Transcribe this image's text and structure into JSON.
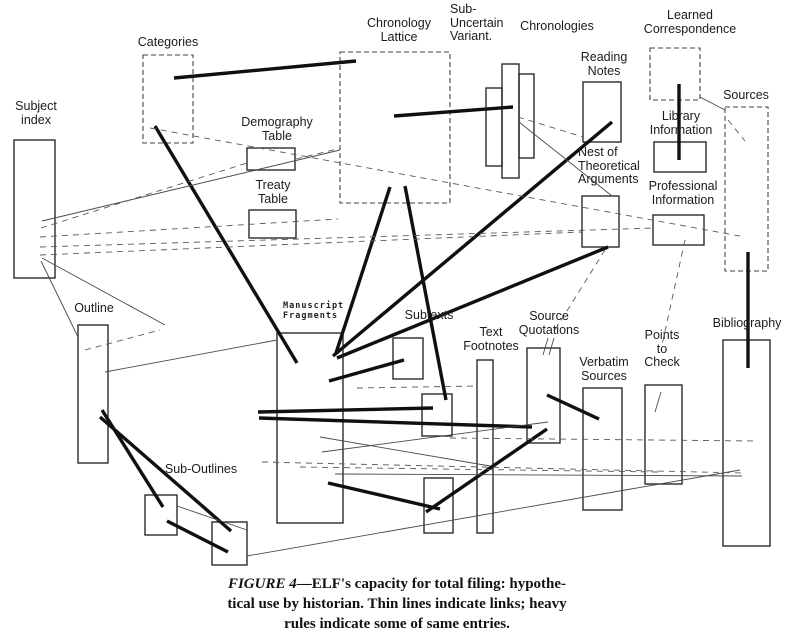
{
  "colors": {
    "ink": "#1b1b1b",
    "paper": "#ffffff"
  },
  "nodes": [
    {
      "id": "subject-index",
      "lines": [
        "Subject",
        "index"
      ],
      "label": {
        "x": 36,
        "y": 100,
        "align": "center"
      },
      "border": "solid",
      "boxes": [
        {
          "x": 14,
          "y": 140,
          "w": 41,
          "h": 138
        }
      ]
    },
    {
      "id": "categories",
      "lines": [
        "Categories"
      ],
      "label": {
        "x": 168,
        "y": 36,
        "align": "center"
      },
      "border": "dashed",
      "boxes": [
        {
          "x": 143,
          "y": 55,
          "w": 50,
          "h": 88
        }
      ]
    },
    {
      "id": "demography-table",
      "lines": [
        "Demography",
        "Table"
      ],
      "label": {
        "x": 277,
        "y": 116,
        "align": "center"
      },
      "border": "solid",
      "boxes": [
        {
          "x": 247,
          "y": 148,
          "w": 48,
          "h": 22
        }
      ]
    },
    {
      "id": "treaty-table",
      "lines": [
        "Treaty",
        "Table"
      ],
      "label": {
        "x": 273,
        "y": 179,
        "align": "center"
      },
      "border": "solid",
      "boxes": [
        {
          "x": 249,
          "y": 210,
          "w": 47,
          "h": 28
        }
      ]
    },
    {
      "id": "chronology-lattice",
      "lines": [
        "Chronology",
        "Lattice"
      ],
      "label": {
        "x": 399,
        "y": 17,
        "align": "center"
      },
      "border": "dashed",
      "boxes": [
        {
          "x": 340,
          "y": 52,
          "w": 110,
          "h": 151
        }
      ]
    },
    {
      "id": "sub-uncertain-variant",
      "lines": [
        "Sub-",
        "Uncertain",
        "Variant."
      ],
      "label": {
        "x": 450,
        "y": 3,
        "align": "left"
      },
      "border": "solid",
      "boxes": []
    },
    {
      "id": "chronologies",
      "lines": [
        "Chronologies"
      ],
      "label": {
        "x": 557,
        "y": 20,
        "align": "center"
      },
      "border": "solid",
      "boxes": [
        {
          "x": 486,
          "y": 88,
          "w": 16,
          "h": 78
        },
        {
          "x": 502,
          "y": 64,
          "w": 17,
          "h": 114
        },
        {
          "x": 519,
          "y": 74,
          "w": 15,
          "h": 84
        }
      ]
    },
    {
      "id": "reading-notes",
      "lines": [
        "Reading",
        "Notes"
      ],
      "label": {
        "x": 604,
        "y": 51,
        "align": "center"
      },
      "border": "solid",
      "boxes": [
        {
          "x": 583,
          "y": 82,
          "w": 38,
          "h": 60
        }
      ]
    },
    {
      "id": "learned-correspondence",
      "lines": [
        "Learned",
        "Correspondence"
      ],
      "label": {
        "x": 690,
        "y": 9,
        "align": "center"
      },
      "border": "dashed",
      "boxes": [
        {
          "x": 650,
          "y": 48,
          "w": 50,
          "h": 52
        }
      ]
    },
    {
      "id": "sources",
      "lines": [
        "Sources"
      ],
      "label": {
        "x": 746,
        "y": 89,
        "align": "center"
      },
      "border": "dashed",
      "boxes": [
        {
          "x": 725,
          "y": 107,
          "w": 43,
          "h": 164
        }
      ]
    },
    {
      "id": "library-information",
      "lines": [
        "Library",
        "Information"
      ],
      "label": {
        "x": 681,
        "y": 110,
        "align": "center"
      },
      "border": "solid",
      "boxes": [
        {
          "x": 654,
          "y": 142,
          "w": 52,
          "h": 30
        }
      ]
    },
    {
      "id": "nest-of-theoretical-arguments",
      "lines": [
        "Nest of",
        "Theoretical",
        "Arguments"
      ],
      "label": {
        "x": 578,
        "y": 146,
        "align": "left"
      },
      "border": "solid",
      "boxes": [
        {
          "x": 582,
          "y": 196,
          "w": 37,
          "h": 51
        }
      ]
    },
    {
      "id": "professional-information",
      "lines": [
        "Professional",
        "Information"
      ],
      "label": {
        "x": 683,
        "y": 180,
        "align": "center"
      },
      "border": "solid",
      "boxes": [
        {
          "x": 653,
          "y": 215,
          "w": 51,
          "h": 30
        }
      ]
    },
    {
      "id": "outline",
      "lines": [
        "Outline"
      ],
      "label": {
        "x": 94,
        "y": 302,
        "align": "center"
      },
      "border": "solid",
      "boxes": [
        {
          "x": 78,
          "y": 325,
          "w": 30,
          "h": 138
        }
      ]
    },
    {
      "id": "manuscript-fragments",
      "lines": [
        "Manuscript",
        "Fragments"
      ],
      "label": {
        "x": 283,
        "y": 301,
        "align": "left"
      },
      "font": "mono",
      "border": "solid",
      "boxes": [
        {
          "x": 277,
          "y": 333,
          "w": 66,
          "h": 190
        }
      ]
    },
    {
      "id": "subtexts",
      "lines": [
        "Subtexts"
      ],
      "label": {
        "x": 429,
        "y": 309,
        "align": "center"
      },
      "border": "solid",
      "boxes": [
        {
          "x": 393,
          "y": 338,
          "w": 30,
          "h": 41
        },
        {
          "x": 422,
          "y": 394,
          "w": 30,
          "h": 42
        },
        {
          "x": 424,
          "y": 478,
          "w": 29,
          "h": 55
        }
      ]
    },
    {
      "id": "text-footnotes",
      "lines": [
        "Text",
        "Footnotes"
      ],
      "label": {
        "x": 491,
        "y": 326,
        "align": "center"
      },
      "border": "solid",
      "boxes": [
        {
          "x": 477,
          "y": 360,
          "w": 16,
          "h": 173
        }
      ]
    },
    {
      "id": "source-quotations",
      "lines": [
        "Source",
        "Quotations"
      ],
      "label": {
        "x": 549,
        "y": 310,
        "align": "center"
      },
      "border": "solid",
      "boxes": [
        {
          "x": 527,
          "y": 348,
          "w": 33,
          "h": 95
        }
      ]
    },
    {
      "id": "verbatim-sources",
      "lines": [
        "Verbatim",
        "Sources"
      ],
      "label": {
        "x": 604,
        "y": 356,
        "align": "center"
      },
      "border": "solid",
      "boxes": [
        {
          "x": 583,
          "y": 388,
          "w": 39,
          "h": 122
        }
      ]
    },
    {
      "id": "points-to-check",
      "lines": [
        "Points",
        "to",
        "Check"
      ],
      "label": {
        "x": 662,
        "y": 329,
        "align": "center"
      },
      "border": "solid",
      "boxes": [
        {
          "x": 645,
          "y": 385,
          "w": 37,
          "h": 99
        }
      ]
    },
    {
      "id": "bibliography",
      "lines": [
        "Bibliography"
      ],
      "label": {
        "x": 747,
        "y": 317,
        "align": "center"
      },
      "border": "solid",
      "boxes": [
        {
          "x": 723,
          "y": 340,
          "w": 47,
          "h": 206
        }
      ]
    },
    {
      "id": "sub-outlines",
      "lines": [
        "Sub-Outlines"
      ],
      "label": {
        "x": 201,
        "y": 463,
        "align": "center"
      },
      "border": "solid",
      "boxes": [
        {
          "x": 145,
          "y": 495,
          "w": 32,
          "h": 40
        },
        {
          "x": 212,
          "y": 522,
          "w": 35,
          "h": 43
        }
      ]
    }
  ],
  "links": {
    "heavy": [
      [
        174,
        78,
        356,
        61
      ],
      [
        155,
        126,
        297,
        363
      ],
      [
        394,
        116,
        513,
        107
      ],
      [
        390,
        187,
        336,
        353
      ],
      [
        405,
        186,
        446,
        400
      ],
      [
        333,
        356,
        612,
        122
      ],
      [
        337,
        358,
        608,
        247
      ],
      [
        329,
        381,
        404,
        360
      ],
      [
        258,
        412,
        433,
        408
      ],
      [
        259,
        418,
        532,
        427
      ],
      [
        328,
        483,
        440,
        509
      ],
      [
        426,
        512,
        547,
        429
      ],
      [
        102,
        410,
        163,
        507
      ],
      [
        100,
        417,
        231,
        531
      ],
      [
        167,
        521,
        228,
        552
      ],
      [
        547,
        395,
        599,
        419
      ],
      [
        679,
        84,
        679,
        160
      ],
      [
        748,
        252,
        748,
        368
      ]
    ],
    "thin": [
      [
        42,
        221,
        340,
        150
      ],
      [
        41,
        261,
        78,
        337
      ],
      [
        42,
        258,
        165,
        325
      ],
      [
        700,
        97,
        725,
        110
      ],
      [
        322,
        452,
        548,
        422
      ],
      [
        320,
        437,
        490,
        466
      ],
      [
        247,
        556,
        740,
        470
      ],
      [
        177,
        506,
        247,
        530
      ],
      [
        105,
        372,
        277,
        340
      ],
      [
        335,
        474,
        742,
        476
      ],
      [
        661,
        392,
        655,
        412
      ],
      [
        548,
        338,
        543,
        355
      ],
      [
        554,
        338,
        549,
        355
      ],
      [
        519,
        122,
        612,
        196
      ]
    ],
    "dashed": [
      [
        41,
        228,
        247,
        163
      ],
      [
        40,
        237,
        338,
        219
      ],
      [
        40,
        247,
        655,
        228
      ],
      [
        40,
        255,
        582,
        232
      ],
      [
        150,
        128,
        745,
        237
      ],
      [
        728,
        120,
        745,
        141
      ],
      [
        518,
        117,
        583,
        137
      ],
      [
        685,
        240,
        662,
        345
      ],
      [
        605,
        250,
        555,
        330
      ],
      [
        262,
        462,
        745,
        473
      ],
      [
        300,
        467,
        658,
        472
      ],
      [
        450,
        438,
        755,
        441
      ],
      [
        357,
        388,
        478,
        386
      ],
      [
        296,
        159,
        337,
        149
      ],
      [
        85,
        350,
        160,
        330
      ]
    ]
  },
  "caption": {
    "figure_label": "FIGURE 4",
    "line1_rest": "—ELF's capacity for total filing: hypothe-",
    "line2": "tical use by historian. Thin lines indicate links; heavy",
    "line3": "rules indicate some of same entries."
  }
}
